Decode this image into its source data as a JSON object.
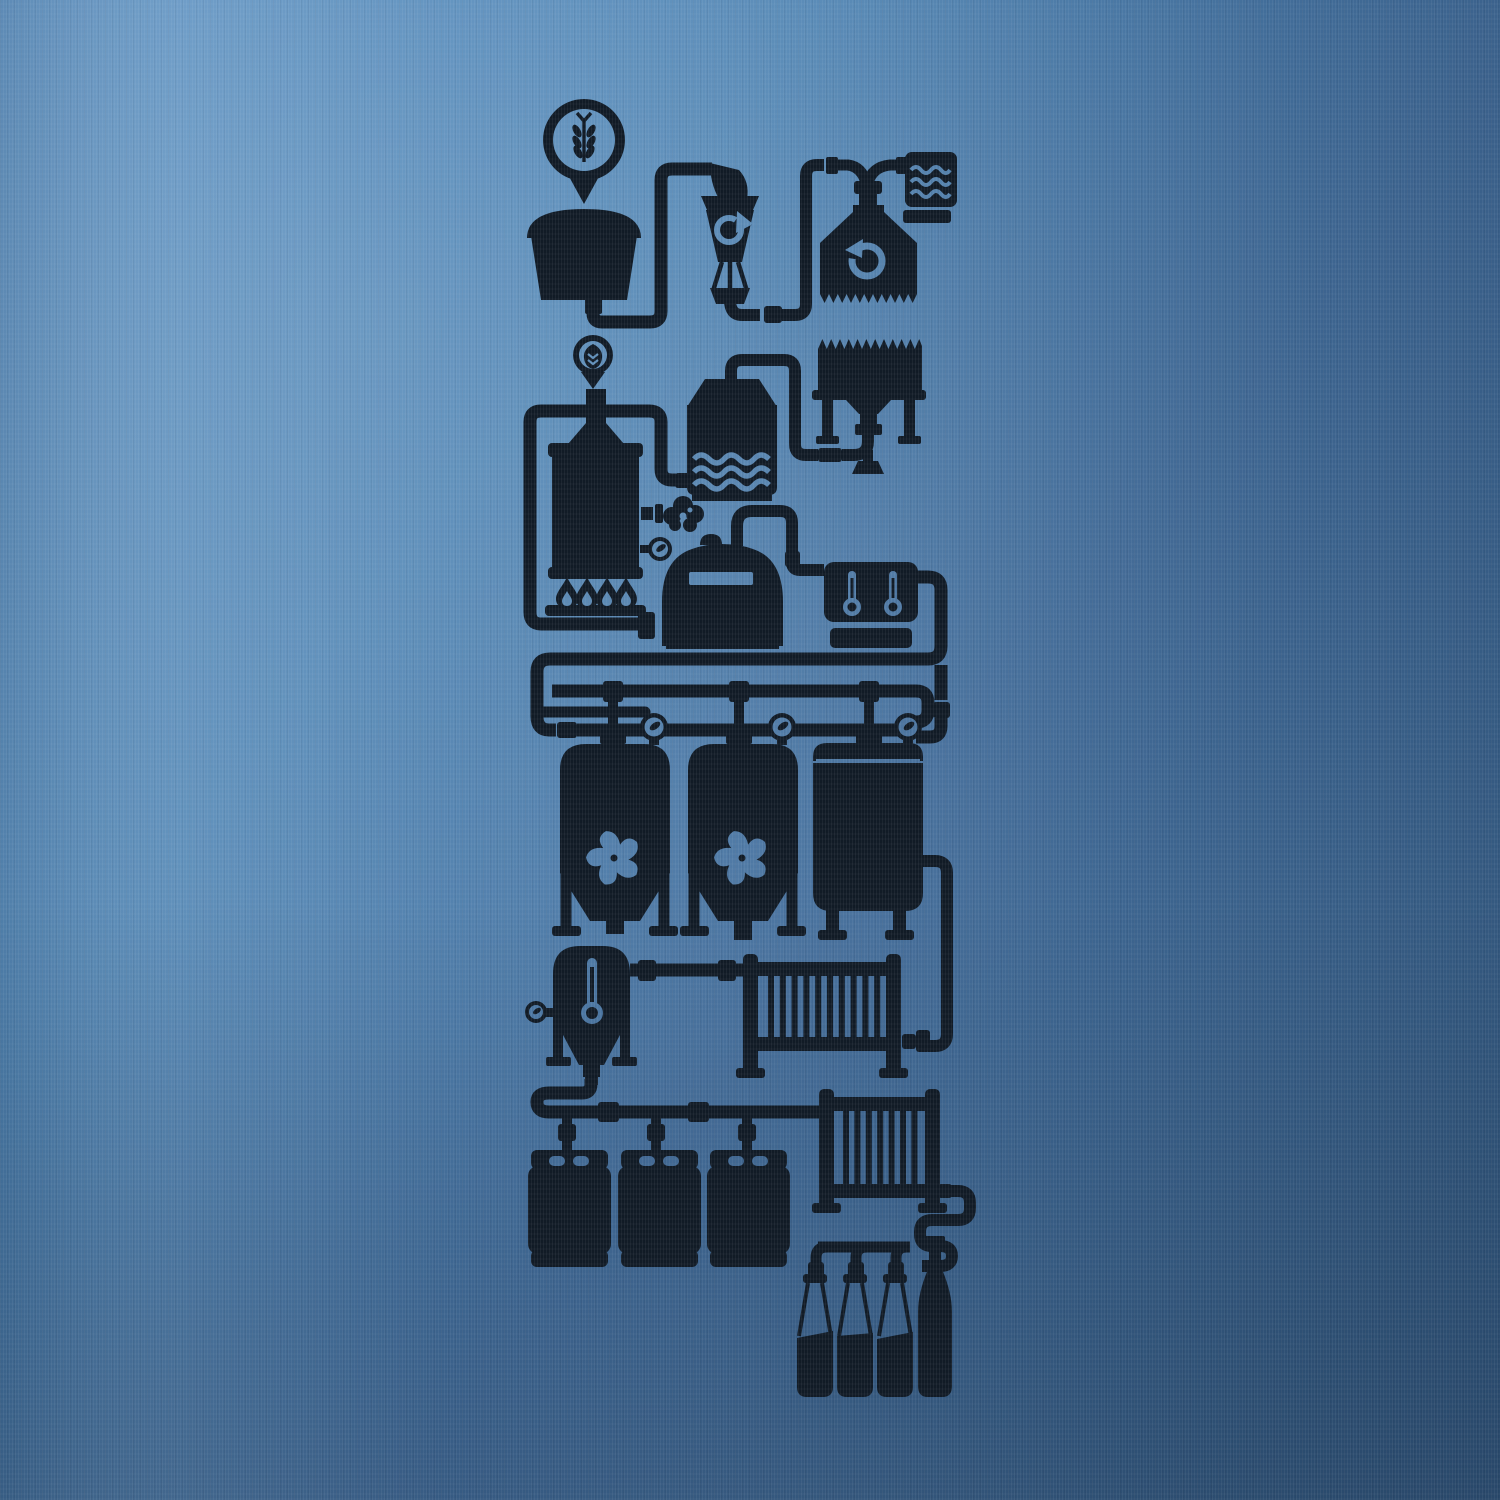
{
  "artwork": {
    "title": "Light blue t-shirt with black screen-printed beer brewing process flow diagram",
    "kind": "t-shirt print, no text",
    "colors": {
      "fabric_light": "#5f93c3",
      "fabric_mid": "#4a7cab",
      "fabric_dark": "#3a638c",
      "ink": "#111b26"
    },
    "nodes": {
      "malt_pin": {
        "label": "Location pin with barley grain symbol"
      },
      "grain_funnel": {
        "label": "Grain in-feed funnel hopper"
      },
      "grist_mill": {
        "label": "Grist mill hopper with clockwise recirculation arrow"
      },
      "malt_mill": {
        "label": "Malt mill with counter-clockwise arrow and crushed-grain zigzag outlet"
      },
      "water_box": {
        "label": "Water supply box with three wave lines"
      },
      "grist_case": {
        "label": "Grist case tank with zigzag top, legs and down-spout nozzle"
      },
      "hop_pin": {
        "label": "Location pin with hop cone symbol"
      },
      "brew_kettle": {
        "label": "Brew kettle with burner flames, steam puff and pressure gauge"
      },
      "hot_liquor_tank": {
        "label": "Hot liquor tank with three wave lines"
      },
      "whirlpool_kettle": {
        "label": "Whirlpool dome kettle with sight slot"
      },
      "temp_control": {
        "label": "Temperature control unit with two thermometers"
      },
      "pipe_manifold": {
        "label": "Serpentine pipe manifold with three tee drops and three round valves"
      },
      "fermenter_1": {
        "label": "Conical fermenter with cooling fan cutout"
      },
      "fermenter_2": {
        "label": "Conical fermenter with cooling fan cutout"
      },
      "bright_tank": {
        "label": "Bright beer tank on legs with side pipe"
      },
      "settling_tank": {
        "label": "Conditioning tank with thermometer and gauge"
      },
      "heat_exchanger_1": {
        "label": "Plate heat exchanger radiator"
      },
      "heat_exchanger_2": {
        "label": "Second plate heat exchanger radiator"
      },
      "kegs": {
        "label": "Three beer kegs being filled from manifold"
      },
      "bottling": {
        "label": "Bottling manifold with three filler hoses"
      },
      "bottles": {
        "label": "Three bottles being filled plus one capped bottle"
      }
    }
  }
}
